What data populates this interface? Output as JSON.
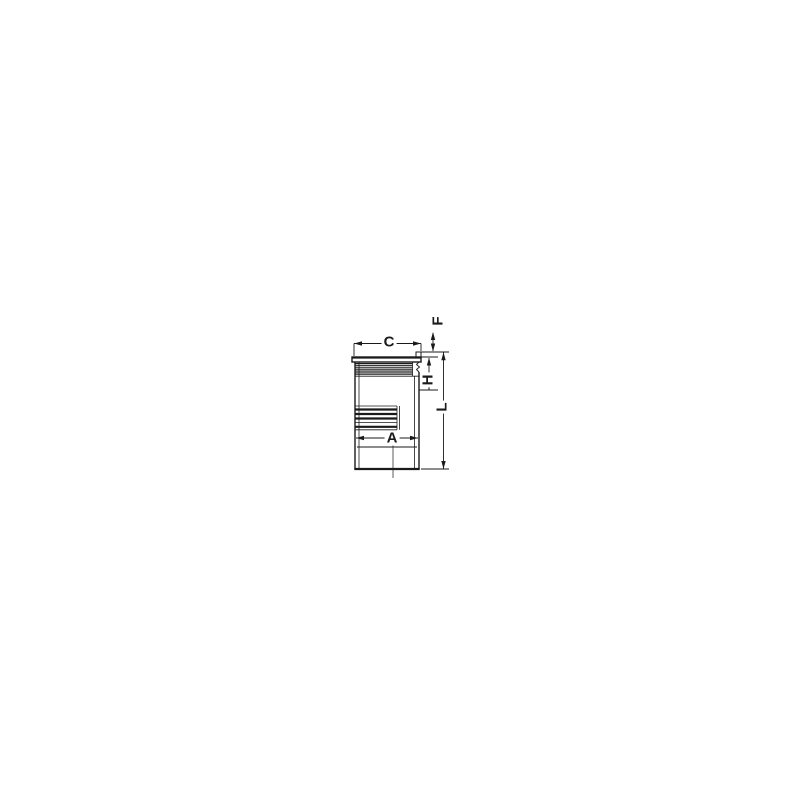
{
  "page": {
    "background": "#ffffff"
  },
  "drawing": {
    "line_color": "#1a1a1a",
    "labels": {
      "C": "C",
      "F": "F",
      "H": "H",
      "A": "A",
      "L": "L"
    }
  }
}
